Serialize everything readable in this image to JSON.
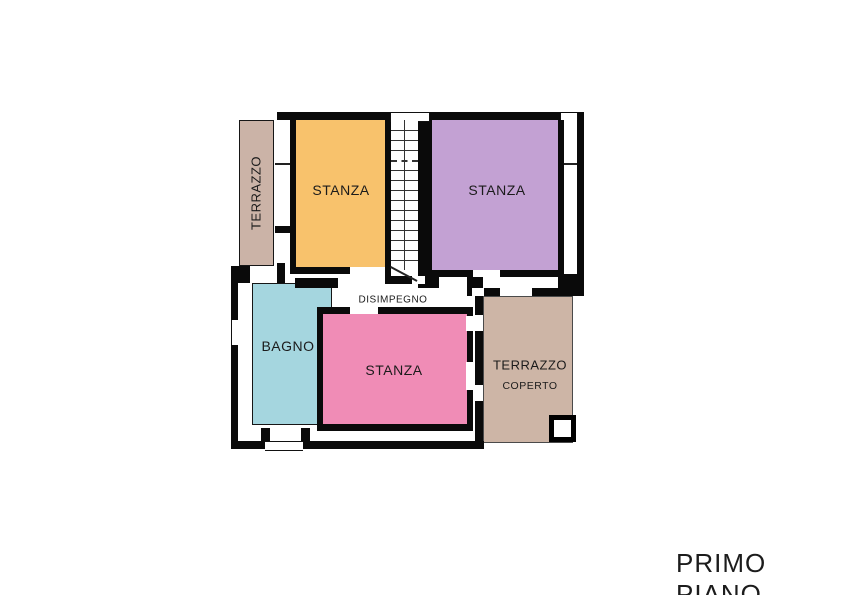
{
  "title": {
    "text": "PRIMO PIANO"
  },
  "plan": {
    "rooms": {
      "terrazzo_left": {
        "label": "TERRAZZO",
        "color": "#CBB3A7"
      },
      "stanza_top_left": {
        "label": "STANZA",
        "color": "#F8C26C"
      },
      "stanza_top_right": {
        "label": "STANZA",
        "color": "#C3A1D3"
      },
      "disimpegno": {
        "label": "DISIMPEGNO"
      },
      "bagno": {
        "label": "BAGNO",
        "color": "#A5D6DF"
      },
      "stanza_bottom": {
        "label": "STANZA",
        "color": "#F08CB6"
      },
      "terrazzo_coperto": {
        "label": "TERRAZZO",
        "label2": "COPERTO",
        "color": "#CDB5A6"
      }
    },
    "stairs": {
      "steps": 14
    },
    "wall_color": "#0a0a0a"
  }
}
